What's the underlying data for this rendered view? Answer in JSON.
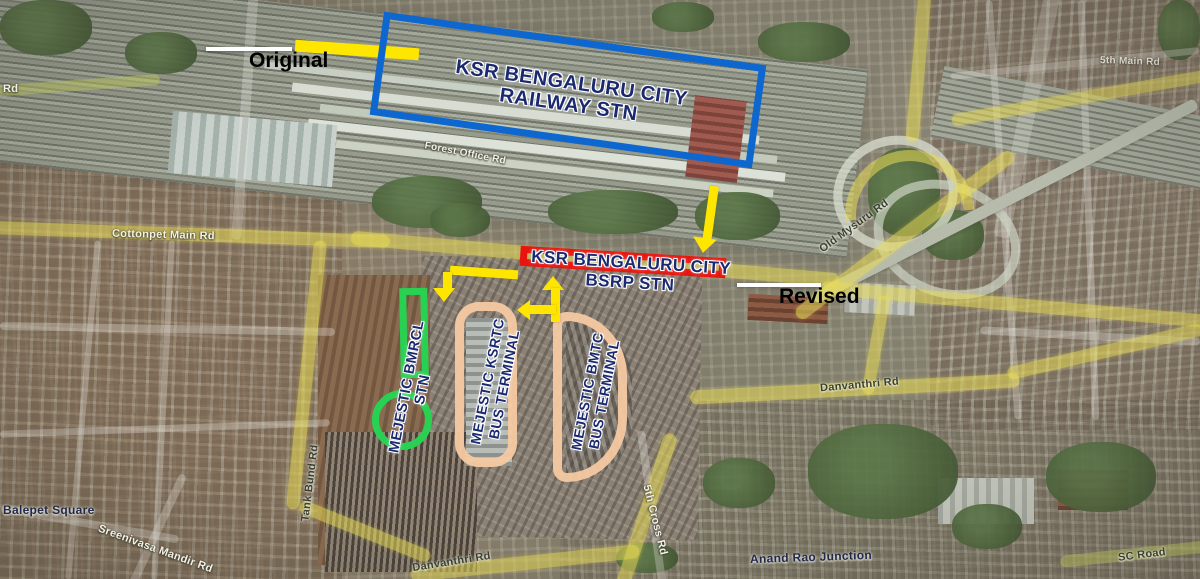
{
  "annotations": {
    "original": {
      "label": "Original"
    },
    "revised": {
      "label": "Revised"
    },
    "railway_station": {
      "line1": "KSR BENGALURU CITY",
      "line2": "RAILWAY  STN"
    },
    "bsrp_station": {
      "line1": "KSR BENGALURU CITY",
      "line2": "BSRP  STN"
    },
    "metro_station": {
      "label": "MEJESTIC BMRCL STN"
    },
    "ksrtc_terminal": {
      "line1": "MEJESTIC KSRTC",
      "line2": "BUS TERMINAL"
    },
    "bmtc_terminal": {
      "line1": "MEJESTIC BMTC",
      "line2": "BUS TERMINAL"
    }
  },
  "road_labels": [
    {
      "id": "cottonpet",
      "text": "Cottonpet Main Rd"
    },
    {
      "id": "old-mysuru",
      "text": "Old Mysuru Rd"
    },
    {
      "id": "tank-bund",
      "text": "Tank Bund Rd"
    },
    {
      "id": "danvantri-right",
      "text": "Danvanthri Rd"
    },
    {
      "id": "danvantri-bottom",
      "text": "Danvanthri Rd"
    },
    {
      "id": "fifth-cross",
      "text": "5th Cross Rd"
    },
    {
      "id": "anand-rao",
      "text": "Anand Rao Junction"
    },
    {
      "id": "sc-road",
      "text": "SC Road"
    },
    {
      "id": "balepet",
      "text": "Balepet Square"
    },
    {
      "id": "sreenivasa",
      "text": "Sreenivasa Mandir Rd"
    },
    {
      "id": "forest-office",
      "text": "Forest Office Rd"
    },
    {
      "id": "fifth-main",
      "text": "5th Main Rd"
    },
    {
      "id": "left-edge",
      "text": "Rd"
    }
  ],
  "colors": {
    "original_box": "#fee600",
    "railway_box": "#0e66cf",
    "revised_box": "#e8140e",
    "metro_outline": "#29d152",
    "terminal_outline": "#f6c9a2",
    "station_text": "#1b2a70",
    "arrow": "#fee600"
  }
}
